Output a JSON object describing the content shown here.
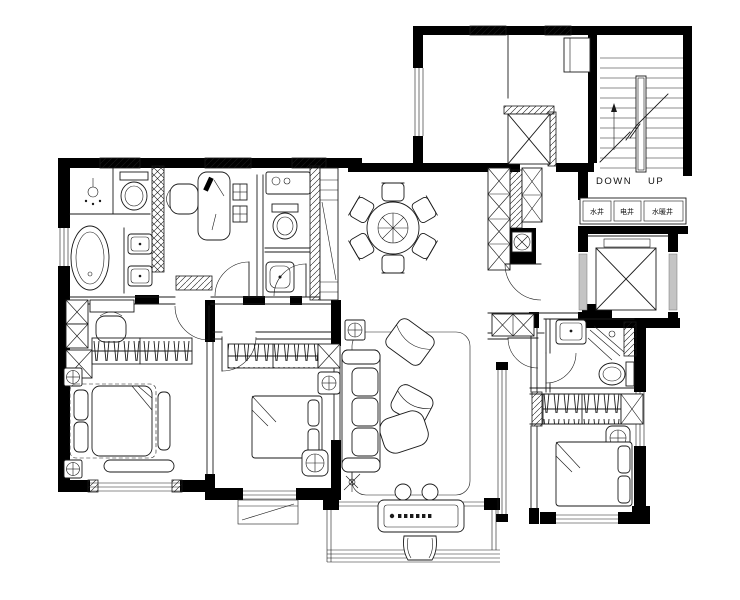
{
  "document": {
    "type": "architectural floor plan",
    "description": "Black-and-white residential apartment floor plan with furniture layout, public elevator lobby, utility shafts and stairwell"
  },
  "labels": {
    "stair_down": "DOWN",
    "stair_up": "UP",
    "shaft_water": "水井",
    "shaft_electric": "电井",
    "shaft_plumbing": "水暖井"
  },
  "colors": {
    "background": "#ffffff",
    "wall_fill": "#000000",
    "line": "#1a1a1a",
    "elevator_door_panel": "#c4c4c4"
  },
  "fixtures": [
    "stairs",
    "public-elevator",
    "private-elevator",
    "utility-shafts",
    "bathtub",
    "shower",
    "toilet",
    "double-vanity",
    "laundry-basin",
    "desk",
    "office-chair",
    "bookshelf",
    "dining-table",
    "dining-chairs",
    "entry-cabinet",
    "tall-cabinet",
    "water-heater",
    "wardrobe-hangers",
    "double-bed",
    "nightstand-lamp",
    "dressing-table",
    "sofa",
    "armchair",
    "lounge-chair",
    "rug",
    "floor-lamp",
    "plant",
    "piano",
    "piano-stool",
    "stools",
    "balcony-rail"
  ]
}
